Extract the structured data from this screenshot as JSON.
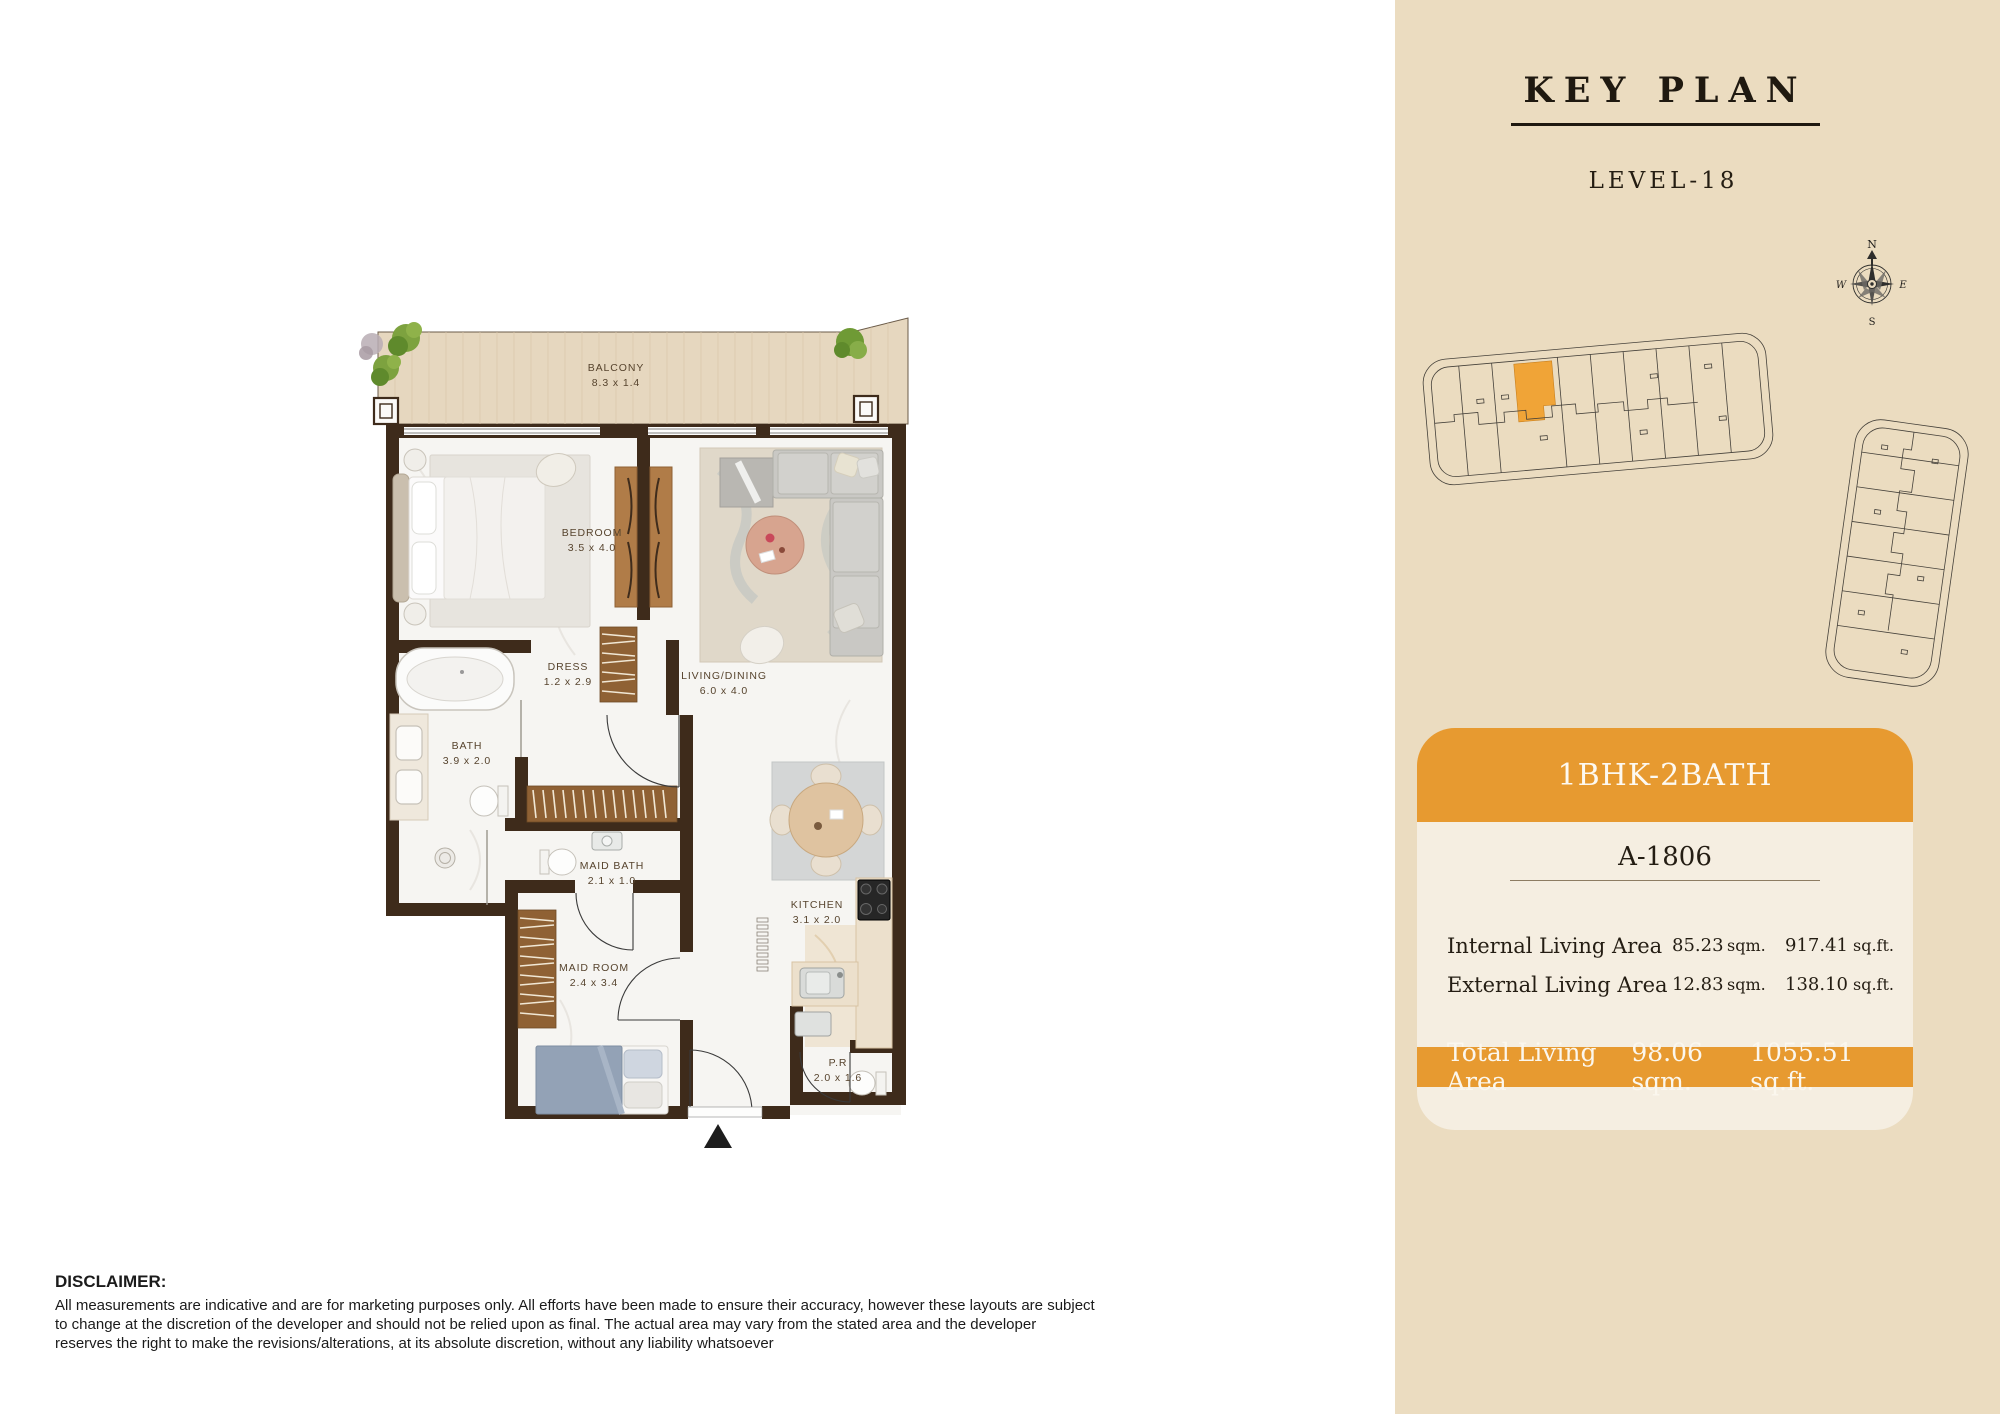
{
  "plan": {
    "rooms": [
      {
        "name": "BALCONY",
        "dims": "8.3 x 1.4"
      },
      {
        "name": "BEDROOM",
        "dims": "3.5 x 4.0"
      },
      {
        "name": "DRESS",
        "dims": "1.2 x 2.9"
      },
      {
        "name": "BATH",
        "dims": "3.9 x 2.0"
      },
      {
        "name": "LIVING/DINING",
        "dims": "6.0 x 4.0"
      },
      {
        "name": "MAID BATH",
        "dims": "2.1 x 1.0"
      },
      {
        "name": "MAID ROOM",
        "dims": "2.4 x 3.4"
      },
      {
        "name": "KITCHEN",
        "dims": "3.1 x 2.0"
      },
      {
        "name": "P.R",
        "dims": "2.0 x 1.6"
      }
    ]
  },
  "key_plan": {
    "title": "KEY PLAN",
    "level": "LEVEL-18",
    "compass": {
      "n": "N",
      "e": "E",
      "s": "S",
      "w": "W"
    }
  },
  "unit_card": {
    "type": "1BHK-2BATH",
    "unit": "A-1806",
    "rows": [
      {
        "label": "Internal Living Area",
        "sqm": "85.23",
        "sqm_unit": "sqm.",
        "sqft": "917.41",
        "sqft_unit": "sq.ft."
      },
      {
        "label": "External Living Area",
        "sqm": "12.83",
        "sqm_unit": "sqm.",
        "sqft": "138.10",
        "sqft_unit": "sq.ft."
      }
    ],
    "total": {
      "label": "Total Living Area",
      "sqm": "98.06 sqm.",
      "sqft": "1055.51 sq.ft."
    }
  },
  "disclaimer": {
    "title": "DISCLAIMER:",
    "body": "All measurements are indicative and are for marketing purposes only. All efforts have been made to ensure their accuracy, however these layouts are subject to change at the discretion of the developer and should not be relied upon as final. The actual area may vary from the stated area and the developer reserves the right to make the revisions/alterations, at its absolute discretion, without any liability whatsoever"
  },
  "colors": {
    "accent_orange": "#E79A30",
    "panel_beige": "#EBDCC0",
    "card_cream": "#F5EEE1",
    "wall_brown": "#3E2B1B",
    "highlight_unit_orange": "#F0A437",
    "balcony_wood": "#E6D7BF"
  }
}
